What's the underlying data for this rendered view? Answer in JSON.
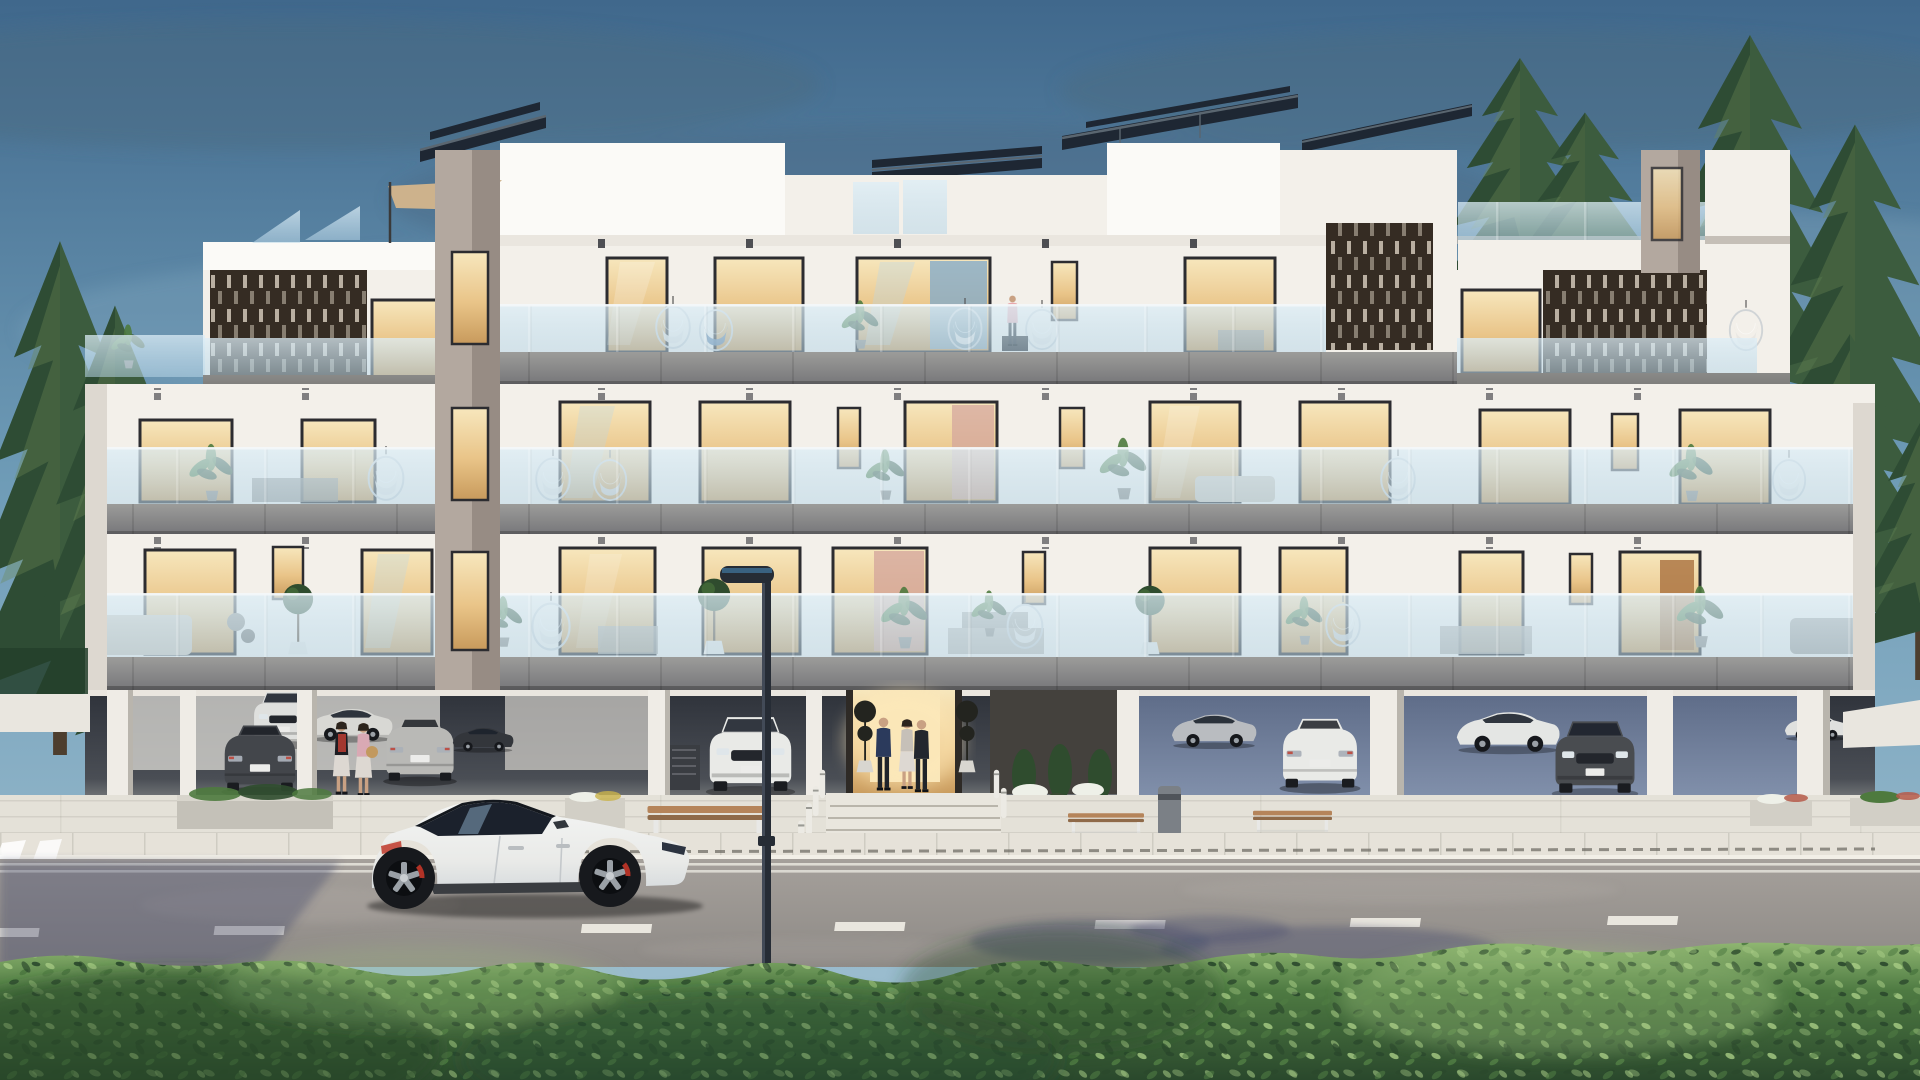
{
  "scene": {
    "title": "Modern three-storey apartment building exterior render at dusk",
    "sky": "dusk blue sky with soft grey cloud streaks",
    "objects": {
      "building": "white apartment block with three balcony floors over open parking",
      "solar_panels": "tilted rooftop photovoltaic arrays",
      "lattice_screens": "dark perforated timber privacy screens on penthouse level",
      "balcony_glass": "frameless glass balustrades reflecting the sky",
      "windows": "floor-to-ceiling sliders glowing warm from interior lighting",
      "entrance": "warm-lit lobby with two topiary trees and three residents talking",
      "parking": "open ground-level parking with parked sedans and SUVs",
      "street_furniture": "timber benches, concrete planters, litter bin, white bollards",
      "street_lamp": "dark modern street light in front of the building",
      "sports_car": "white fastback electric sedan parked on the road",
      "road": "asphalt road with dashed white lane markings and tree shadows",
      "hedge": "trimmed green hedge across the foreground",
      "trees": "tall pine trees flanking and behind the building",
      "people": "residents on the top balcony and beside the parked cars"
    }
  },
  "palette": {
    "sky_top": "#40688c",
    "sky_mid": "#6f9cb7",
    "sky_low": "#a3c3d3",
    "cloud_dark": "#4b6a81",
    "cloud_light": "#85a9bf",
    "tree_dark": "#23402b",
    "tree_mid": "#3c5c3e",
    "tree_light": "#6d8a56",
    "trunk": "#4d3e2e",
    "wall_white": "#f3f0ea",
    "wall_bright": "#fbfaf7",
    "wall_shade": "#ddd8d0",
    "wall_mauve": "#b3a89f",
    "wall_mauve_dk": "#978c84",
    "soffit": "#eae6df",
    "slab_light": "#9c9c9a",
    "slab_dark": "#77777a",
    "slab_wing": "#6b6a68",
    "lattice_dark": "#352c23",
    "lattice_slot": "#d9cfc0",
    "glass_tint": "#b9d7e8",
    "glass_rail": "#ddeef7",
    "win_frame": "#2c2c30",
    "win_warm_hi": "#f7e7bd",
    "win_warm": "#e9c488",
    "win_warm_dk": "#c89a5c",
    "curtain_pink": "#d3a49c",
    "curtain_blue": "#7fa8c9",
    "solar_dark": "#1e2733",
    "solar_frame": "#5a6670",
    "sail_tan": "#cdb28c",
    "park_dark": "#2e323a",
    "park_mid": "#4a4e55",
    "park_wall": "#44413d",
    "park_floor": "#c7c5c0",
    "drive_blue": "#5f6d89",
    "drive_blue_hi": "#8291ac",
    "pillar": "#efece6",
    "sidewalk": "#d8d4cb",
    "walk_hi": "#e4e1d8",
    "curb": "#e6e2d9",
    "road_hi": "#a5a09b",
    "road_lo": "#8e8a86",
    "road_line": "#e9e6de",
    "shadow_cool": "#4e5270",
    "hedge_hi": "#8fb671",
    "hedge_mid": "#4e7a42",
    "hedge_dark": "#2a482c",
    "leaf_hi": "#a8cc85",
    "car_white": "#f4f5f4",
    "car_white_dk": "#d8dcde",
    "car_dark": "#43464b",
    "car_silver": "#b9b9b6",
    "car_white2": "#e9eae8",
    "glass_car": "#1b212c",
    "wheel_dark": "#17191d",
    "rim_gray": "#9aa0a6",
    "brake_red": "#b23226",
    "tail_red": "#c0392b",
    "wood_bench": "#b5845a",
    "metal_gray": "#cdd2d5",
    "skin": "#c9a183",
    "suit_navy": "#2b3a5c",
    "suit_dark": "#23272e",
    "coat_light": "#c6c0b8",
    "dress_black": "#1d1d22",
    "scarf_red": "#b23c32",
    "top_pink": "#d9a9b4",
    "skirt_light": "#ddd8d2",
    "person_pink": "#e8a7ac",
    "pot_white": "#e9e7e1",
    "plant_green": "#4e7a3e",
    "plant_dark": "#2f4c2e",
    "flower_white": "#eef0e8",
    "bin_gray": "#7b8086",
    "lamp_dark": "#262c35",
    "bollard": "#eceae4"
  }
}
